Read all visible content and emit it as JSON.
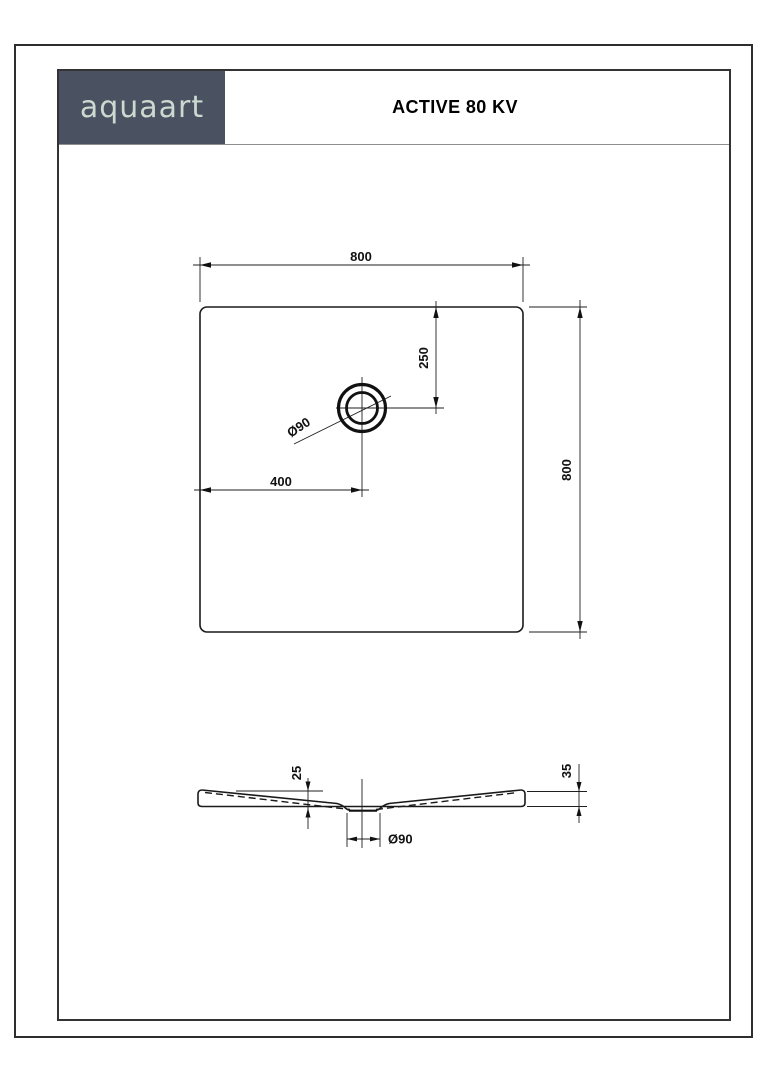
{
  "header": {
    "logo_text": "aquaart",
    "title": "ACTIVE 80 KV",
    "logo_bg_color": "#4a5161",
    "logo_text_color": "#ccd9d0"
  },
  "top_view": {
    "width_label": "800",
    "height_label": "800",
    "drain_offset_left_label": "400",
    "drain_offset_top_label": "250",
    "drain_diameter_label": "Ø90"
  },
  "section_view": {
    "depth_label": "25",
    "edge_height_label": "35",
    "drain_diameter_label": "Ø90"
  }
}
